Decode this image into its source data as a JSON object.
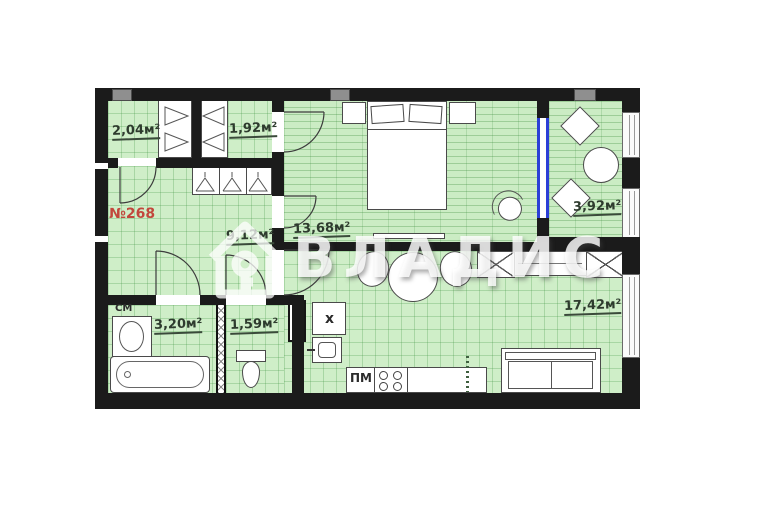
{
  "floorplan": {
    "apartment_number": "№268",
    "watermark": "ВЛАДИС",
    "rooms": {
      "storage_a": {
        "area": "2,04м²"
      },
      "storage_b": {
        "area": "1,92м²"
      },
      "hallway": {
        "area": "9,12м²"
      },
      "bedroom": {
        "area": "13,68м²"
      },
      "balcony": {
        "area": "3,92м²"
      },
      "bathroom": {
        "area": "3,20м²"
      },
      "wc": {
        "area": "1,59м²"
      },
      "living_kitchen": {
        "area": "17,42м²"
      }
    },
    "appliance_labels": {
      "washing_machine": "СМ",
      "fridge": "х",
      "dishwasher": "ПМ"
    },
    "colors": {
      "floor_green": "#cfeec8",
      "wall_black": "#1b1b1b",
      "apartment_number_red": "#c2473c",
      "area_label_green": "#2e3b2e",
      "glazing_blue": "#2b3fd6"
    }
  }
}
